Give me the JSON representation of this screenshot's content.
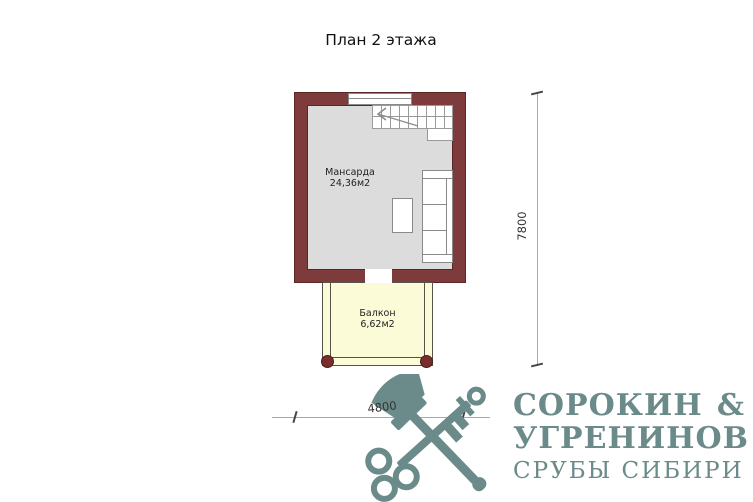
{
  "page": {
    "title": "План 2 этажа"
  },
  "plan": {
    "room": {
      "label": "Мансарда",
      "area": "24,36м2"
    },
    "balcony": {
      "label": "Балкон",
      "area": "6,62м2"
    },
    "dim_width": "4800",
    "dim_height": "7800"
  },
  "logo": {
    "name": "СОРОКИН",
    "ampersand": "&",
    "name2": "УГРЕНИНОВ",
    "tagline": "СРУБЫ СИБИРИ",
    "color": "#6b8a8a"
  },
  "colors": {
    "wall": "#7d3b3b",
    "room_floor": "#dcdcdc",
    "balcony_floor": "#fbfbd8",
    "post": "#7a2d2d",
    "dimension_line": "#a8a8a8"
  }
}
